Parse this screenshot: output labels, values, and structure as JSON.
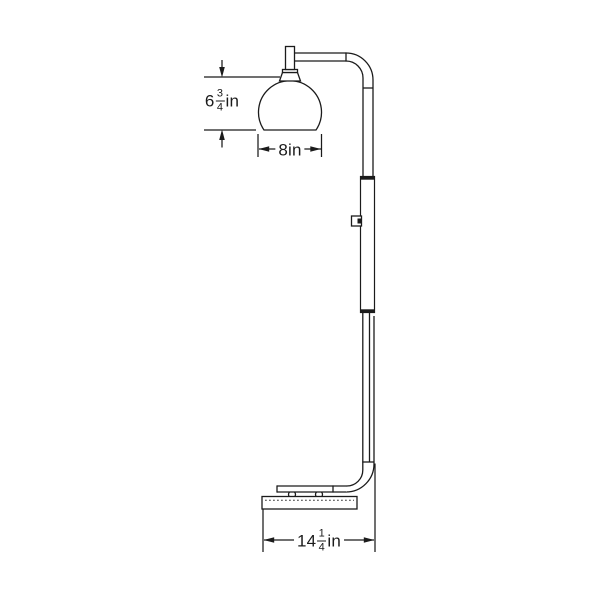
{
  "page": {
    "background": "#ffffff",
    "line_color": "#1b1b1b"
  },
  "dimensions": {
    "shade_height": {
      "whole": "6",
      "numerator": "3",
      "denominator": "4",
      "unit": "in"
    },
    "shade_width": {
      "value": "8",
      "unit": "in"
    },
    "base_width": {
      "whole": "14",
      "numerator": "1",
      "denominator": "4",
      "unit": "in"
    }
  }
}
